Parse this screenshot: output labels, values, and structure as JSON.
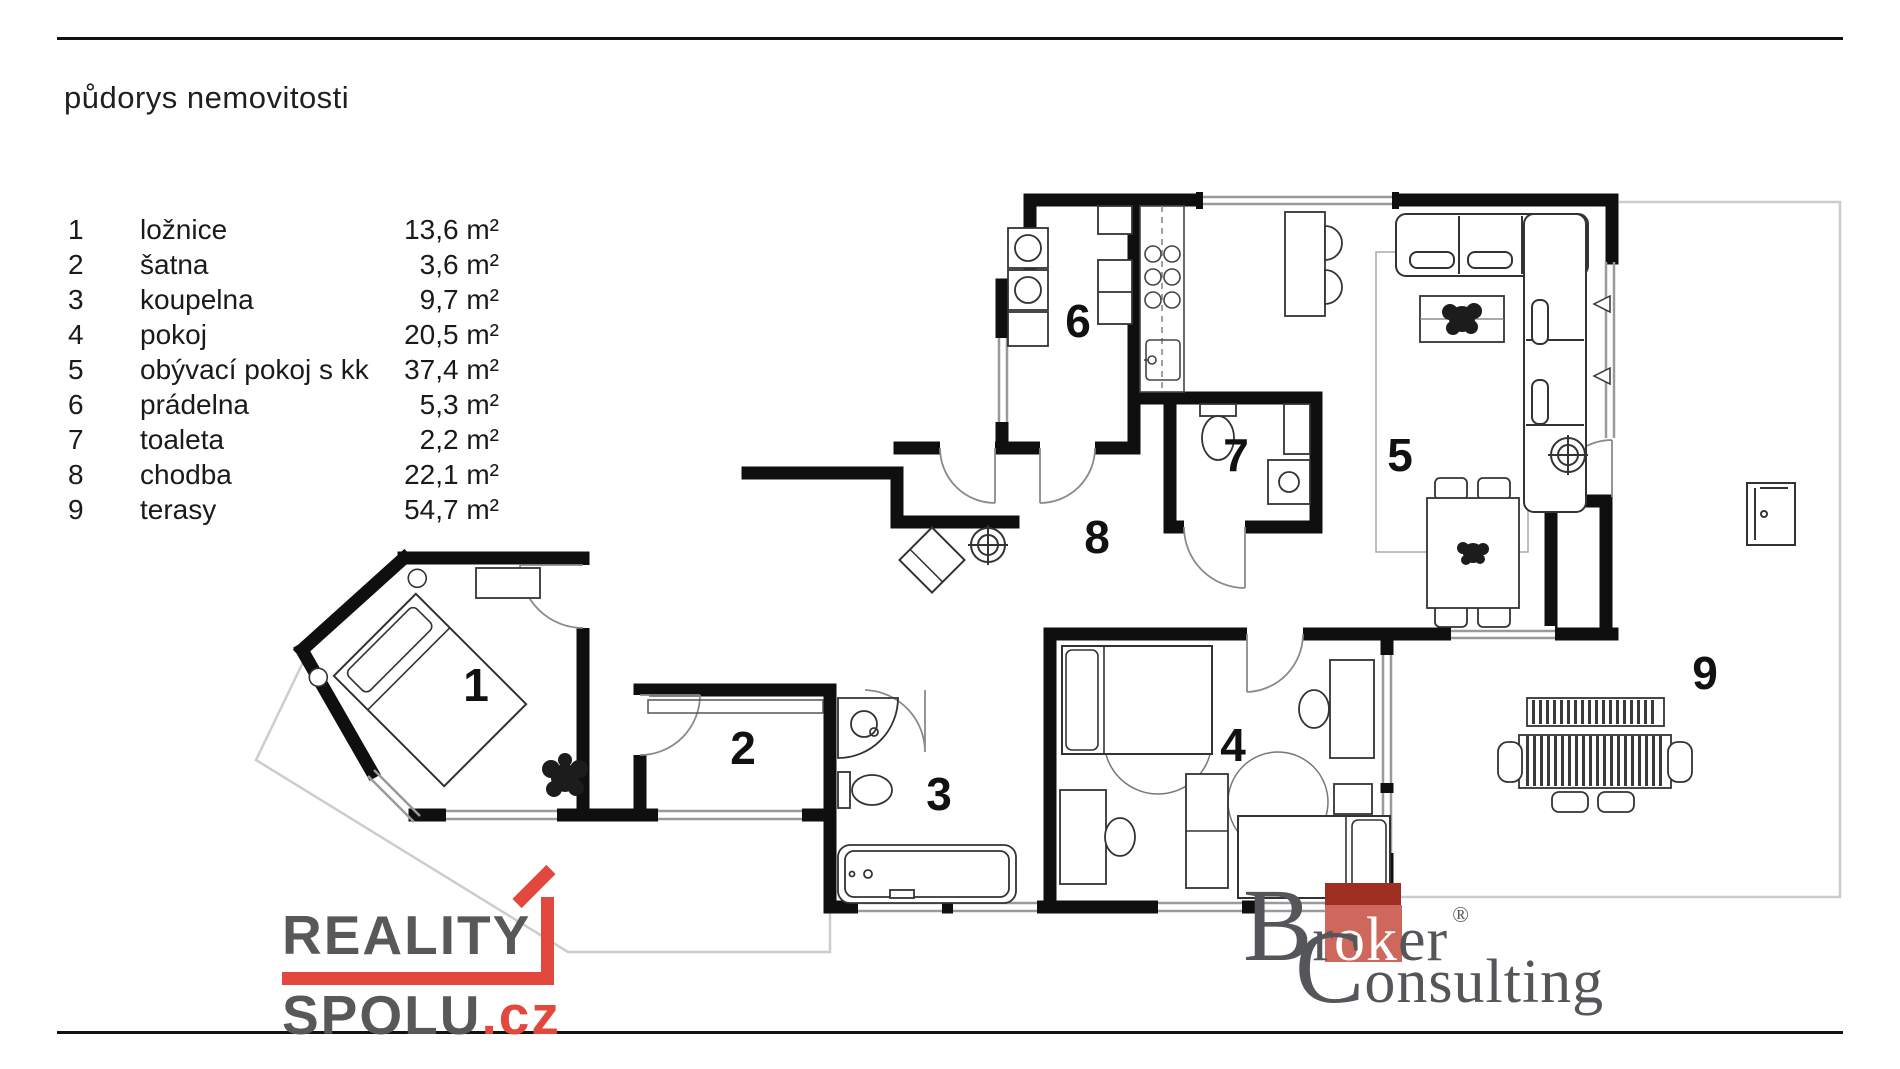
{
  "page": {
    "title": "půdorys nemovitosti"
  },
  "legend": {
    "items": [
      {
        "num": "1",
        "name": "ložnice",
        "area": "13,6 m²"
      },
      {
        "num": "2",
        "name": "šatna",
        "area": "3,6 m²"
      },
      {
        "num": "3",
        "name": "koupelna",
        "area": "9,7 m²"
      },
      {
        "num": "4",
        "name": "pokoj",
        "area": "20,5 m²"
      },
      {
        "num": "5",
        "name": "obývací pokoj s kk",
        "area": "37,4 m²"
      },
      {
        "num": "6",
        "name": "prádelna",
        "area": "5,3 m²"
      },
      {
        "num": "7",
        "name": "toaleta",
        "area": "2,2 m²"
      },
      {
        "num": "8",
        "name": "chodba",
        "area": "22,1 m²"
      },
      {
        "num": "9",
        "name": "terasy",
        "area": "54,7 m²"
      }
    ]
  },
  "plan": {
    "rooms": [
      "1",
      "2",
      "3",
      "4",
      "5",
      "6",
      "7",
      "8",
      "9"
    ],
    "wall_color": "#0f0f0f",
    "window_color": "#9a9a9a",
    "terrace_outline_color": "#cccccc"
  },
  "logos": {
    "reality_spolu": {
      "word1": "REALITY",
      "word2": "SPOLU",
      "tld": ".cz",
      "text_color": "#57585a",
      "accent_color": "#e2483d"
    },
    "broker_consulting": {
      "b": "B",
      "r": "r",
      "ok": "ok",
      "er": "er",
      "reg": "®",
      "c": "C",
      "onsulting": "onsulting",
      "text_color": "#54565a",
      "square_light": "#cf685c",
      "square_dark": "#9e2d22"
    }
  }
}
